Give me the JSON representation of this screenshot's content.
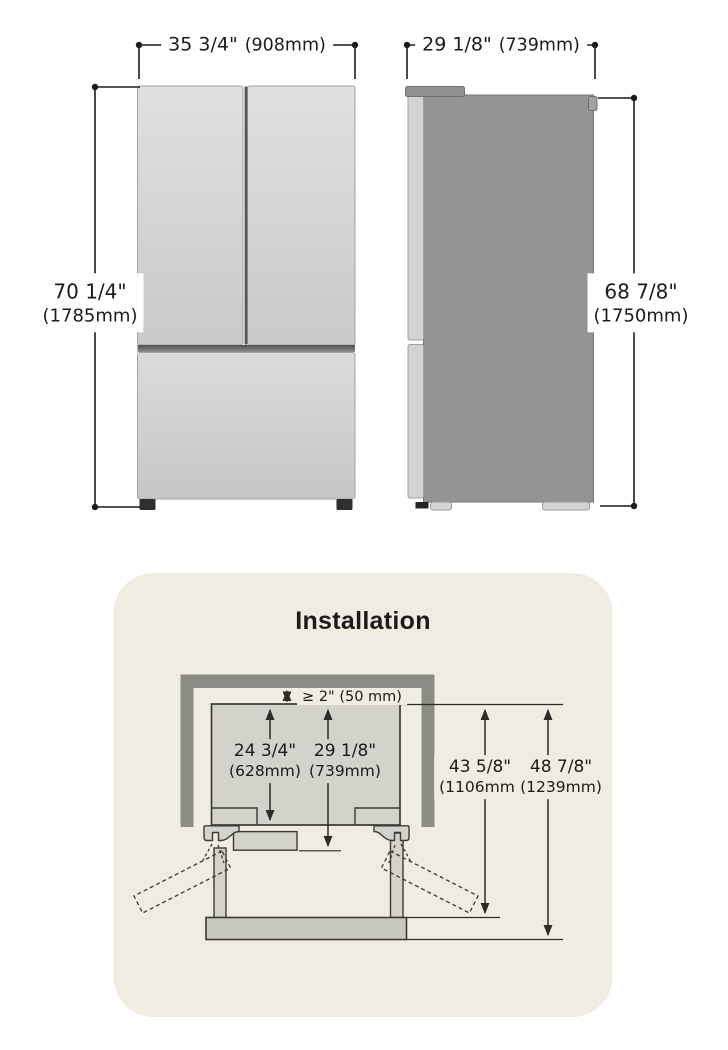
{
  "front_view": {
    "width_in": "35 3/4\"",
    "width_mm": "(908mm)",
    "height_in": "70 1/4\"",
    "height_mm": "(1785mm)"
  },
  "side_view": {
    "depth_in": "29 1/8\"",
    "depth_mm": "(739mm)",
    "height_in": "68 7/8\"",
    "height_mm": "(1750mm)"
  },
  "installation": {
    "title": "Installation",
    "min_top_clearance": "≥ 2\" (50 mm)",
    "cabinet_depth_in": "24 3/4\"",
    "cabinet_depth_mm": "(628mm)",
    "depth_with_door_in": "29 1/8\"",
    "depth_with_door_mm": "(739mm)",
    "depth_door_open_in": "43 5/8\"",
    "depth_door_open_mm": "(1106mm)",
    "total_depth_in": "48 7/8\"",
    "total_depth_mm": "(1239mm)"
  },
  "colors": {
    "panel_background": "#F1ECE2",
    "wall": "#8C8C86",
    "diagram_fill": "#D3D2CB",
    "diagram_outline": "#3A3A36",
    "dimension_line": "#1C1C1C",
    "text": "#1B1B1B",
    "fridge_front_door": "#D5D7D6",
    "fridge_side_body": "#939594"
  }
}
